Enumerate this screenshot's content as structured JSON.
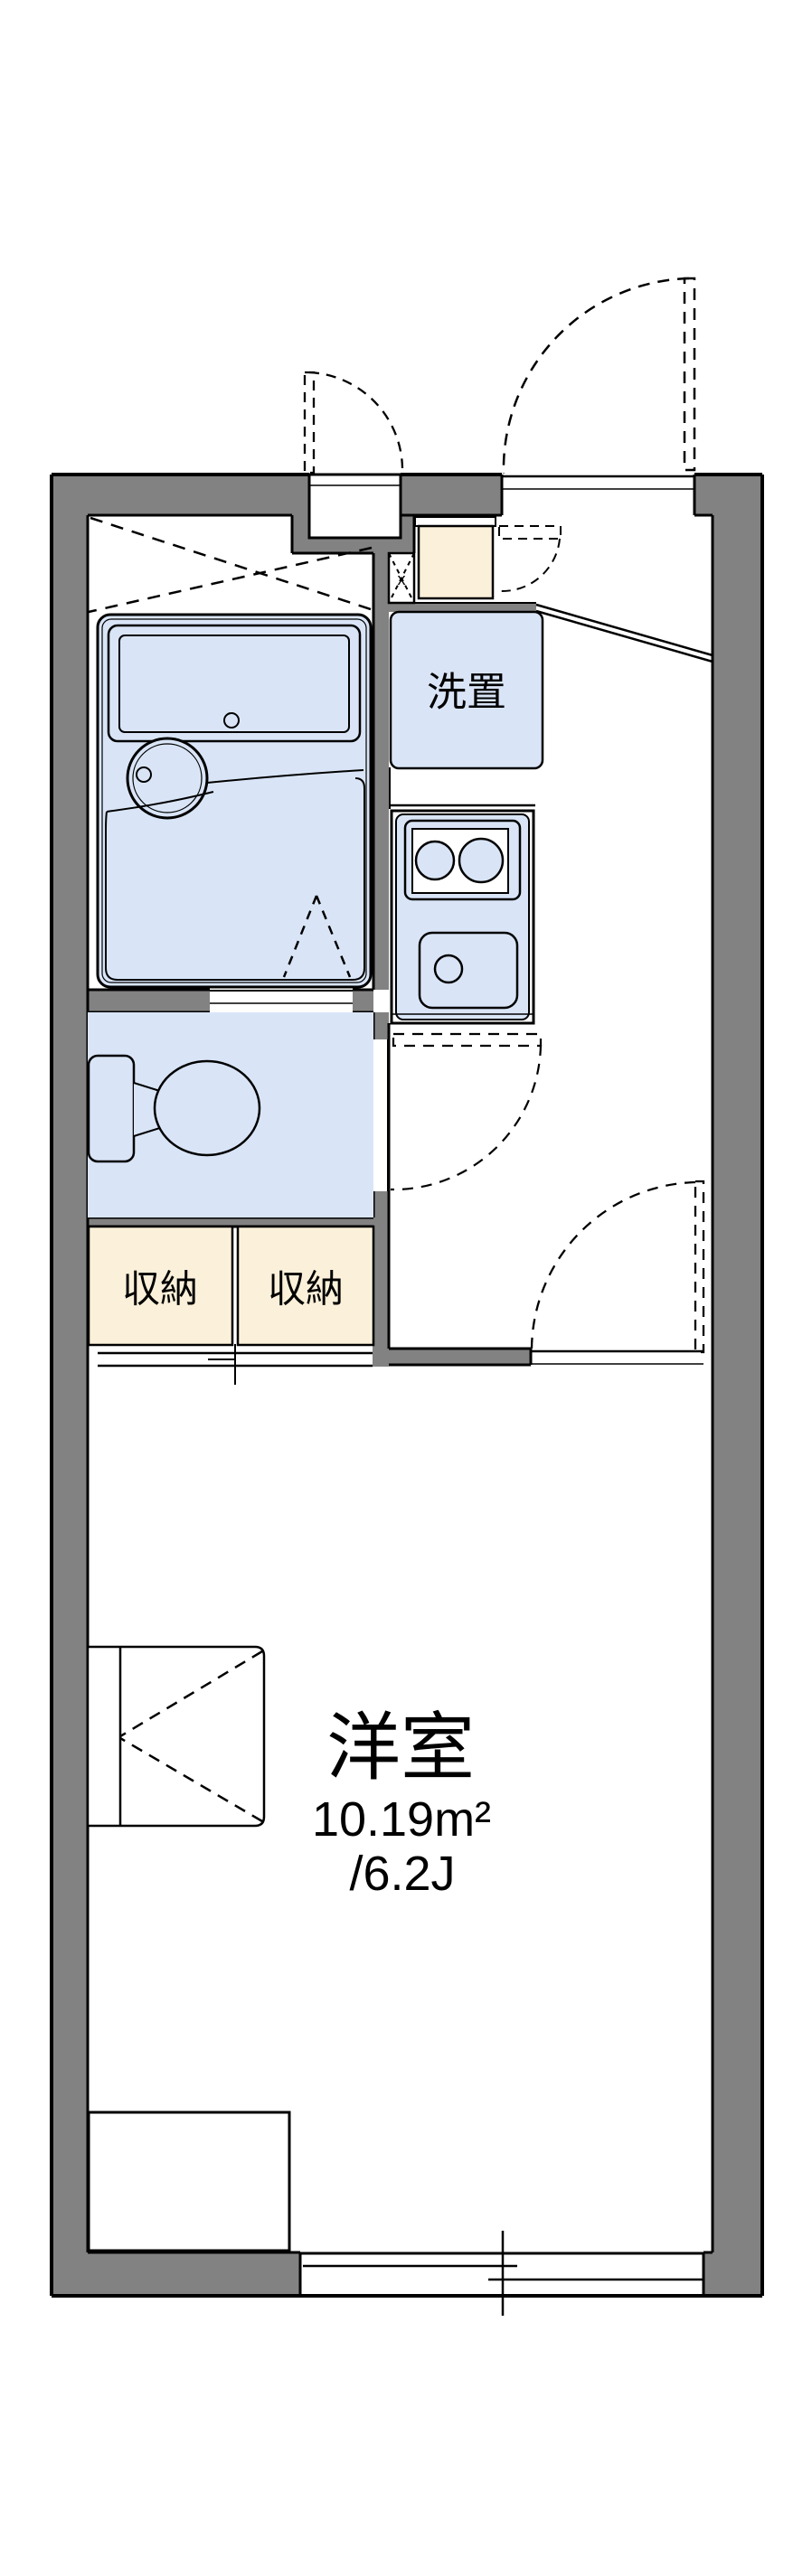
{
  "colors": {
    "background": "#ffffff",
    "wall": "#828282",
    "line": "#000000",
    "fixture": "#d9e5f7",
    "storage": "#fbf0d9"
  },
  "floorplan": {
    "entrance": {
      "meter_box_label": "x"
    },
    "washer": {
      "label": "洗置"
    },
    "closets": {
      "left_label": "収納",
      "right_label": "収納"
    },
    "room": {
      "name": "洋室",
      "area_sqm": "10.19m²",
      "area_tatami": "/6.2J"
    }
  }
}
